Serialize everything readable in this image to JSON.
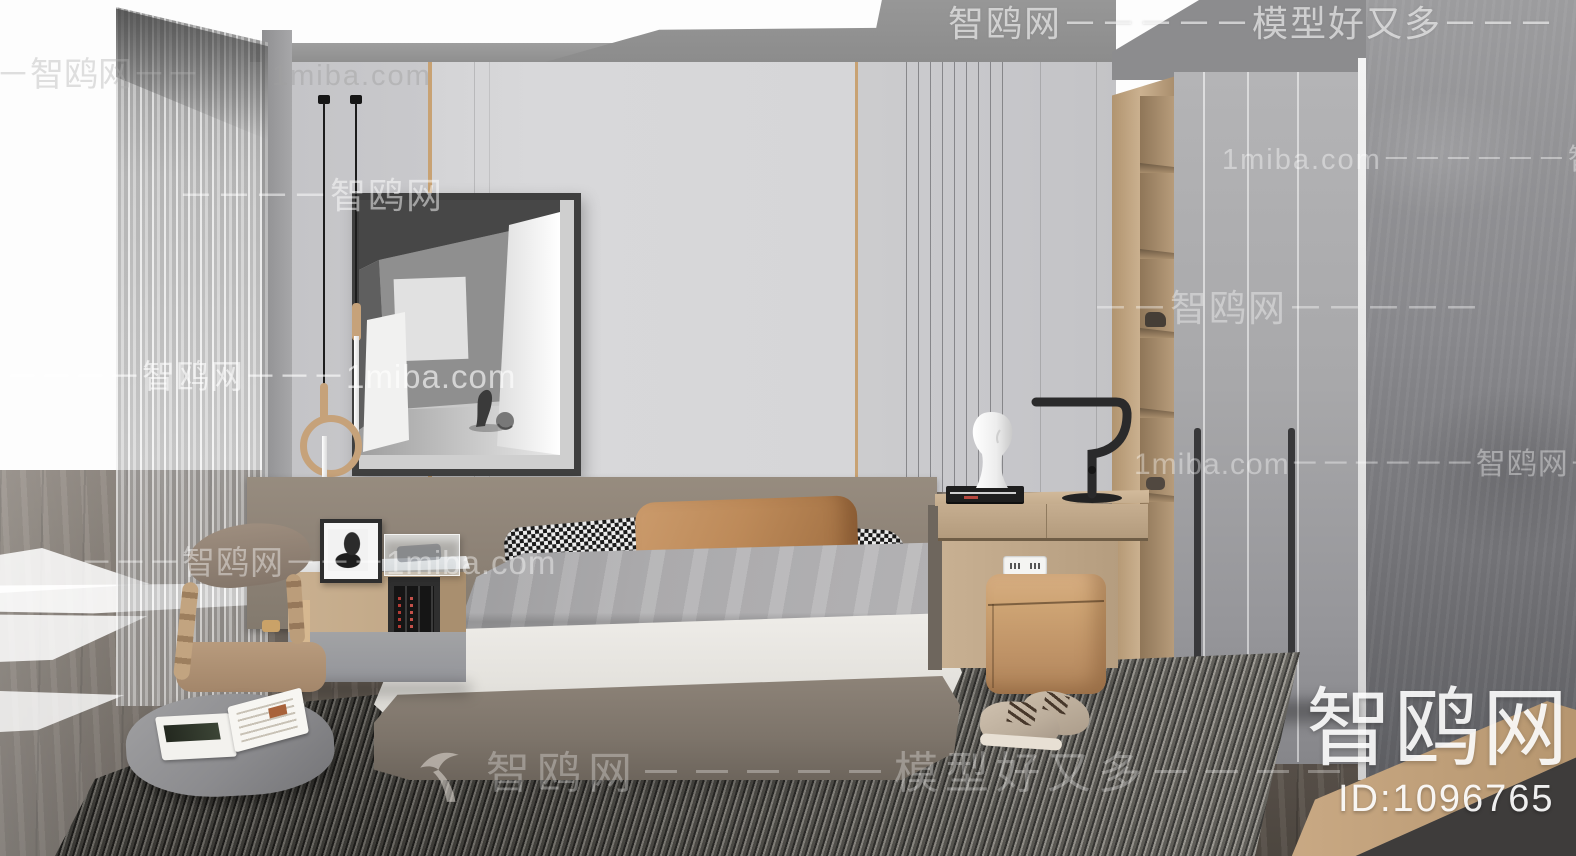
{
  "watermarks": {
    "top_row": "智鸥网－－－－－模型好又多－－－",
    "upper_left_row": "－－智鸥网－－",
    "upper_left_site": "1miba.com",
    "wall_row": "－－－－智鸥网",
    "wardrobe_upper_row": "1miba.com－－－－－－智鸥",
    "wardrobe_mid_row": "－－智鸥网－－－－－",
    "curtain_row": "－－－－智鸥网－－－1miba.com",
    "wardrobe_lower_row": "1miba.com－－－－－－智鸥网－－",
    "nightstand_row": "－－－智鸥网－－－1miba.com",
    "bottom_row": "智鸥网－－－－－模型好又多－－－－",
    "logo_text": "智鸥网",
    "id_text": "ID:1096765"
  },
  "icons": {
    "bird_logo": "seagull-swoosh-icon"
  },
  "colors": {
    "wall": "#d5d5d7",
    "gold_trim": "#c8a273",
    "wood": "#c4aa8a",
    "headboard": "#8e8377",
    "duvet": "#a8a8aa",
    "sheet": "#eae8e4",
    "accent_pillow": "#bf8a5e",
    "pouf": "#c99d72",
    "floor": "#6b6259",
    "rug_dark": "#2c2b28",
    "concrete": "#808084",
    "watermark": "#ffffff"
  }
}
